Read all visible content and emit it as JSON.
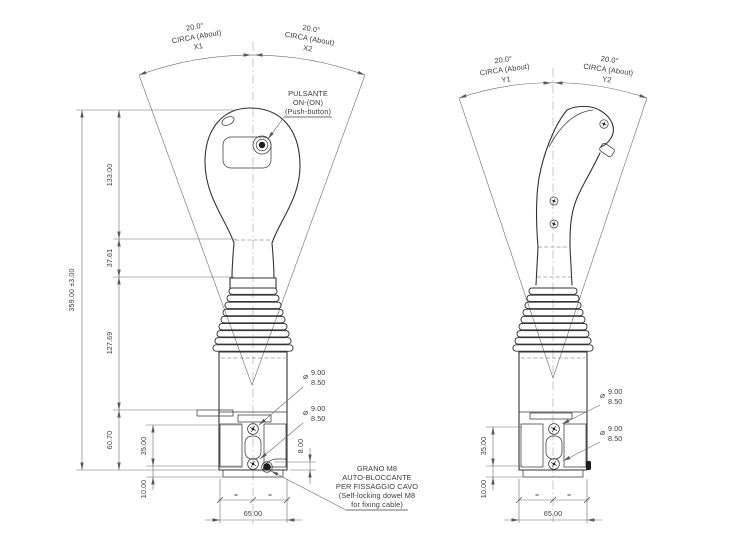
{
  "front_view": {
    "angles": {
      "left": {
        "value": "20.0°",
        "circa": "CIRCA (About)",
        "id": "X1"
      },
      "right": {
        "value": "20.0°",
        "circa": "CIRCA (About)",
        "id": "X2"
      }
    },
    "pushbutton_note": [
      "PULSANTE",
      "ON-(ON)",
      "(Push-button)"
    ],
    "dowel_note": [
      "GRANO M8",
      "AUTO-BLOCCANTE",
      "PER FISSAGGIO CAVO",
      "(Self-locking dowel M8",
      "for fixing cable)"
    ],
    "dims": {
      "overall": "359.00 ±3.00",
      "head": "133.00",
      "neck": "37.61",
      "bellows": "127.69",
      "base": "60.70",
      "base_upper": "35.00",
      "base_lower": "10.00",
      "dowel_offset": "8.00",
      "width": "65.00"
    },
    "holes": {
      "symbol": "⌀",
      "upper": {
        "major": "9.00",
        "minor": "8.50"
      },
      "lower": {
        "major": "9.00",
        "minor": "8.50"
      }
    },
    "equal_mark": "="
  },
  "side_view": {
    "angles": {
      "left": {
        "value": "20.0°",
        "circa": "CIRCA (About)",
        "id": "Y1"
      },
      "right": {
        "value": "20.0°",
        "circa": "CIRCA (About)",
        "id": "Y2"
      }
    },
    "dims": {
      "base_upper": "35.00",
      "base_lower": "10.00",
      "width": "65.00"
    },
    "holes": {
      "symbol": "⌀",
      "upper": {
        "major": "9.00",
        "minor": "8.50"
      },
      "lower": {
        "major": "9.00",
        "minor": "8.50"
      }
    },
    "equal_mark": "="
  }
}
